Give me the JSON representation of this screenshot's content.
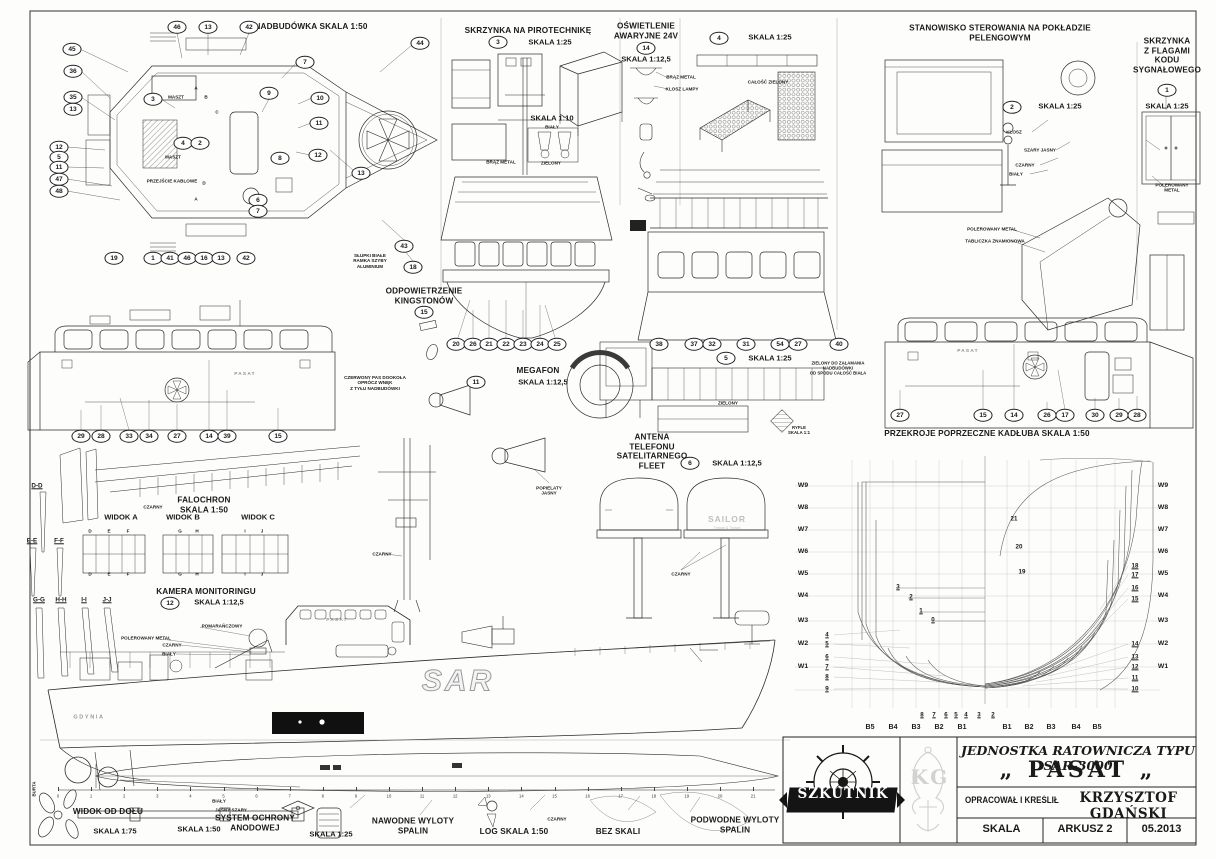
{
  "title_block": {
    "brand": "SZKUTNIK",
    "monogram": "KG",
    "line1": "JEDNOSTKA RATOWNICZA TYPU SAR-3000",
    "ship_name": "„ PASAT „",
    "credit_label": "OPRACOWAŁ I KREŚLIŁ",
    "credit_name": "KRZYSZTOF GDAŃSKI",
    "scale_label": "SKALA",
    "sheet_label": "ARKUSZ 2",
    "date": "05.2013"
  },
  "ruler": {
    "numbers": [
      0,
      1,
      2,
      3,
      4,
      5,
      6,
      7,
      8,
      9,
      10,
      11,
      12,
      13,
      14,
      15,
      16,
      17,
      18,
      19,
      20,
      21
    ],
    "x0": 58,
    "dx": 33.1,
    "y": 796
  },
  "callouts": [
    {
      "n": "46",
      "x": 177,
      "y": 27
    },
    {
      "n": "13",
      "x": 208,
      "y": 27
    },
    {
      "n": "42",
      "x": 249,
      "y": 27
    },
    {
      "n": "44",
      "x": 420,
      "y": 43
    },
    {
      "n": "45",
      "x": 72,
      "y": 49
    },
    {
      "n": "36",
      "x": 73,
      "y": 71
    },
    {
      "n": "35",
      "x": 73,
      "y": 97
    },
    {
      "n": "13",
      "x": 73,
      "y": 109
    },
    {
      "n": "12",
      "x": 59,
      "y": 147
    },
    {
      "n": "5",
      "x": 59,
      "y": 157
    },
    {
      "n": "11",
      "x": 59,
      "y": 167
    },
    {
      "n": "47",
      "x": 59,
      "y": 179
    },
    {
      "n": "48",
      "x": 59,
      "y": 191
    },
    {
      "n": "19",
      "x": 114,
      "y": 258
    },
    {
      "n": "1",
      "x": 153,
      "y": 258
    },
    {
      "n": "41",
      "x": 170,
      "y": 258
    },
    {
      "n": "46",
      "x": 187,
      "y": 258
    },
    {
      "n": "16",
      "x": 204,
      "y": 258
    },
    {
      "n": "13",
      "x": 221,
      "y": 258
    },
    {
      "n": "42",
      "x": 246,
      "y": 258
    },
    {
      "n": "7",
      "x": 305,
      "y": 62
    },
    {
      "n": "9",
      "x": 269,
      "y": 93
    },
    {
      "n": "10",
      "x": 320,
      "y": 98
    },
    {
      "n": "11",
      "x": 319,
      "y": 123
    },
    {
      "n": "12",
      "x": 318,
      "y": 155
    },
    {
      "n": "13",
      "x": 361,
      "y": 173
    },
    {
      "n": "3",
      "x": 153,
      "y": 99
    },
    {
      "n": "4",
      "x": 183,
      "y": 143
    },
    {
      "n": "2",
      "x": 200,
      "y": 143
    },
    {
      "n": "8",
      "x": 280,
      "y": 158
    },
    {
      "n": "6",
      "x": 258,
      "y": 200
    },
    {
      "n": "7",
      "x": 258,
      "y": 211
    },
    {
      "n": "43",
      "x": 404,
      "y": 246
    },
    {
      "n": "18",
      "x": 413,
      "y": 267
    },
    {
      "n": "3",
      "x": 498,
      "y": 42
    },
    {
      "n": "14",
      "x": 646,
      "y": 48
    },
    {
      "n": "4",
      "x": 719,
      "y": 38
    },
    {
      "n": "2",
      "x": 1012,
      "y": 107
    },
    {
      "n": "1",
      "x": 1167,
      "y": 90
    },
    {
      "n": "15",
      "x": 424,
      "y": 312
    },
    {
      "n": "20",
      "x": 456,
      "y": 344
    },
    {
      "n": "26",
      "x": 473,
      "y": 344
    },
    {
      "n": "21",
      "x": 489,
      "y": 344
    },
    {
      "n": "22",
      "x": 506,
      "y": 344
    },
    {
      "n": "23",
      "x": 523,
      "y": 344
    },
    {
      "n": "24",
      "x": 540,
      "y": 344
    },
    {
      "n": "25",
      "x": 557,
      "y": 344
    },
    {
      "n": "11",
      "x": 476,
      "y": 382
    },
    {
      "n": "38",
      "x": 659,
      "y": 344
    },
    {
      "n": "37",
      "x": 694,
      "y": 344
    },
    {
      "n": "32",
      "x": 712,
      "y": 344
    },
    {
      "n": "31",
      "x": 746,
      "y": 344
    },
    {
      "n": "54",
      "x": 780,
      "y": 344
    },
    {
      "n": "27",
      "x": 798,
      "y": 344
    },
    {
      "n": "40",
      "x": 839,
      "y": 344
    },
    {
      "n": "5",
      "x": 726,
      "y": 358
    },
    {
      "n": "6",
      "x": 690,
      "y": 463
    },
    {
      "n": "12",
      "x": 170,
      "y": 603
    },
    {
      "n": "29",
      "x": 81,
      "y": 436
    },
    {
      "n": "28",
      "x": 101,
      "y": 436
    },
    {
      "n": "33",
      "x": 129,
      "y": 436
    },
    {
      "n": "34",
      "x": 149,
      "y": 436
    },
    {
      "n": "27",
      "x": 177,
      "y": 436
    },
    {
      "n": "14",
      "x": 209,
      "y": 436
    },
    {
      "n": "39",
      "x": 227,
      "y": 436
    },
    {
      "n": "15",
      "x": 278,
      "y": 436
    },
    {
      "n": "27",
      "x": 900,
      "y": 415
    },
    {
      "n": "15",
      "x": 983,
      "y": 415
    },
    {
      "n": "14",
      "x": 1014,
      "y": 415
    },
    {
      "n": "26",
      "x": 1047,
      "y": 415
    },
    {
      "n": "17",
      "x": 1065,
      "y": 415
    },
    {
      "n": "30",
      "x": 1095,
      "y": 415
    },
    {
      "n": "29",
      "x": 1119,
      "y": 415
    },
    {
      "n": "28",
      "x": 1137,
      "y": 415
    }
  ],
  "annotations": [
    {
      "t": "NADBUDÓWKA SKALA 1:50",
      "x": 311,
      "y": 27,
      "c": "h1"
    },
    {
      "t": "SKRZYNKA NA PIROTECHNIKĘ",
      "x": 528,
      "y": 31,
      "c": "h1"
    },
    {
      "t": "SKALA 1:25",
      "x": 550,
      "y": 43,
      "c": "h2"
    },
    {
      "t": "SKALA 1:10",
      "x": 552,
      "y": 119,
      "c": "h2"
    },
    {
      "t": "OŚWIETLENIE\nAWARYJNE 24V",
      "x": 646,
      "y": 31,
      "c": "h1"
    },
    {
      "t": "SKALA 1:12,5",
      "x": 646,
      "y": 60,
      "c": "h2"
    },
    {
      "t": "SKALA 1:25",
      "x": 770,
      "y": 38,
      "c": "h2"
    },
    {
      "t": "STANOWISKO STEROWANIA NA POKŁADZIE PELENGOWYM",
      "x": 1000,
      "y": 33,
      "c": "h1"
    },
    {
      "t": "SKALA 1:25",
      "x": 1060,
      "y": 107,
      "c": "h2"
    },
    {
      "t": "SKRZYNKA\nZ FLAGAMI\nKODU\nSYGNAŁOWEGO",
      "x": 1167,
      "y": 56,
      "c": "h1"
    },
    {
      "t": "SKALA 1:25",
      "x": 1167,
      "y": 107,
      "c": "h2"
    },
    {
      "t": "ODPOWIETRZENIE\nKINGSTONÓW",
      "x": 424,
      "y": 296,
      "c": "h1"
    },
    {
      "t": "MEGAFON",
      "x": 538,
      "y": 371,
      "c": "h1"
    },
    {
      "t": "SKALA 1:12,5",
      "x": 543,
      "y": 383,
      "c": "h2"
    },
    {
      "t": "SKALA 1:25",
      "x": 770,
      "y": 359,
      "c": "h2"
    },
    {
      "t": "ANTENA\nTELEFONU\nSATELITARNEGO\nFLEET",
      "x": 652,
      "y": 452,
      "c": "h1"
    },
    {
      "t": "SKALA 1:12,5",
      "x": 737,
      "y": 464,
      "c": "h2"
    },
    {
      "t": "PRZEKROJE POPRZECZNE KADŁUBA  SKALA 1:50",
      "x": 987,
      "y": 434,
      "c": "h1"
    },
    {
      "t": "FALOCHRON\nSKALA 1:50",
      "x": 204,
      "y": 505,
      "c": "h1"
    },
    {
      "t": "WIDOK A",
      "x": 121,
      "y": 518,
      "c": "h2"
    },
    {
      "t": "WIDOK B",
      "x": 183,
      "y": 518,
      "c": "h2"
    },
    {
      "t": "WIDOK C",
      "x": 258,
      "y": 518,
      "c": "h2"
    },
    {
      "t": "KAMERA MONITORINGU",
      "x": 206,
      "y": 592,
      "c": "h1"
    },
    {
      "t": "SKALA 1:12,5",
      "x": 219,
      "y": 603,
      "c": "h2"
    },
    {
      "t": "RYFLE\nSKALA 1:1",
      "x": 799,
      "y": 430,
      "c": "tn"
    },
    {
      "t": "WIDOK OD DOŁU",
      "x": 108,
      "y": 812,
      "c": "h1"
    },
    {
      "t": "SKALA 1:75",
      "x": 115,
      "y": 832,
      "c": "h2"
    },
    {
      "t": "SKALA 1:50",
      "x": 199,
      "y": 830,
      "c": "h2"
    },
    {
      "t": "SYSTEM OCHRONY\nANODOWEJ",
      "x": 255,
      "y": 823,
      "c": "h1"
    },
    {
      "t": "SKALA 1:25",
      "x": 331,
      "y": 835,
      "c": "h2"
    },
    {
      "t": "NAWODNE WYLOTY\nSPALIN",
      "x": 413,
      "y": 826,
      "c": "h1"
    },
    {
      "t": "LOG  SKALA 1:50",
      "x": 514,
      "y": 832,
      "c": "h1"
    },
    {
      "t": "BEZ SKALI",
      "x": 618,
      "y": 832,
      "c": "h1"
    },
    {
      "t": "PODWODNE WYLOTY\nSPALIN",
      "x": 735,
      "y": 825,
      "c": "h1"
    },
    {
      "t": "MASZT",
      "x": 176,
      "y": 97,
      "c": "s"
    },
    {
      "t": "MASZT",
      "x": 173,
      "y": 157,
      "c": "s"
    },
    {
      "t": "PRZEJŚCIE KABLOWE",
      "x": 172,
      "y": 181,
      "c": "s"
    },
    {
      "t": "SŁUPKI BIAŁE\nRAMKA SZYBY\nALUMINIUM",
      "x": 370,
      "y": 261,
      "c": "s"
    },
    {
      "t": "BIAŁY",
      "x": 552,
      "y": 127,
      "c": "s"
    },
    {
      "t": "ZIELONY",
      "x": 551,
      "y": 163,
      "c": "s"
    },
    {
      "t": "BRĄZ METAL",
      "x": 501,
      "y": 162,
      "c": "s"
    },
    {
      "t": "BRĄZ METAL",
      "x": 681,
      "y": 77,
      "c": "s"
    },
    {
      "t": "KLOSZ LAMPY",
      "x": 682,
      "y": 89,
      "c": "s"
    },
    {
      "t": "CAŁOŚĆ ZIELONY",
      "x": 768,
      "y": 82,
      "c": "s"
    },
    {
      "t": "KLOSZ",
      "x": 1014,
      "y": 132,
      "c": "s"
    },
    {
      "t": "SZARY JASNY",
      "x": 1040,
      "y": 150,
      "c": "s"
    },
    {
      "t": "CZARNY",
      "x": 1025,
      "y": 165,
      "c": "s"
    },
    {
      "t": "BIAŁY",
      "x": 1016,
      "y": 174,
      "c": "s"
    },
    {
      "t": "POLEROWANY METAL",
      "x": 992,
      "y": 229,
      "c": "s"
    },
    {
      "t": "TABLICZKA ZNAMIONOWA",
      "x": 995,
      "y": 241,
      "c": "s"
    },
    {
      "t": "POLEROWANY METAL",
      "x": 1172,
      "y": 188,
      "c": "s"
    },
    {
      "t": "CZERWONY PAS DOOKOŁA\nOPRÓCZ WNĘK\nZ TYŁU NADBUDÓWKI",
      "x": 375,
      "y": 383,
      "c": "s"
    },
    {
      "t": "ZIELONY DO ZAŁAMANIA\nNADBUDÓWKI\nOD SPODU CAŁOŚĆ BIAŁA",
      "x": 838,
      "y": 368,
      "c": "tn"
    },
    {
      "t": "ZIELONY",
      "x": 728,
      "y": 403,
      "c": "s"
    },
    {
      "t": "CZARNY",
      "x": 153,
      "y": 507,
      "c": "s"
    },
    {
      "t": "CZARNY",
      "x": 382,
      "y": 554,
      "c": "s"
    },
    {
      "t": "POPIELATY\nJASNY",
      "x": 549,
      "y": 491,
      "c": "s"
    },
    {
      "t": "CZARNY",
      "x": 681,
      "y": 574,
      "c": "s"
    },
    {
      "t": "POMARAŃCZOWY",
      "x": 222,
      "y": 626,
      "c": "s"
    },
    {
      "t": "POLEROWANY METAL",
      "x": 146,
      "y": 638,
      "c": "s"
    },
    {
      "t": "CZARNY",
      "x": 172,
      "y": 645,
      "c": "s"
    },
    {
      "t": "BIAŁY",
      "x": 169,
      "y": 654,
      "c": "s"
    },
    {
      "t": "BIAŁY",
      "x": 219,
      "y": 801,
      "c": "s"
    },
    {
      "t": "JASNY SZARY",
      "x": 231,
      "y": 810,
      "c": "s"
    },
    {
      "t": "CZARNY",
      "x": 557,
      "y": 819,
      "c": "s"
    },
    {
      "t": "BURTA",
      "x": 34,
      "y": 789,
      "c": "vert"
    },
    {
      "t": "SAILOR",
      "x": 727,
      "y": 519,
      "c": "sailor"
    },
    {
      "t": "Thrane & Thrane",
      "x": 727,
      "y": 528,
      "c": "tt"
    },
    {
      "t": "PASAT",
      "x": 245,
      "y": 375,
      "c": "shipname"
    },
    {
      "t": "PASAT",
      "x": 968,
      "y": 352,
      "c": "shipname"
    },
    {
      "t": "PASAT",
      "x": 337,
      "y": 621,
      "c": "shipname"
    },
    {
      "t": "GDYNIA",
      "x": 89,
      "y": 718,
      "c": "gdynia"
    },
    {
      "t": "SAR",
      "x": 458,
      "y": 681,
      "c": "sar"
    },
    {
      "t": "D",
      "x": 90,
      "y": 531,
      "c": "s"
    },
    {
      "t": "E",
      "x": 109,
      "y": 531,
      "c": "s"
    },
    {
      "t": "F",
      "x": 128,
      "y": 531,
      "c": "s"
    },
    {
      "t": "G",
      "x": 180,
      "y": 531,
      "c": "s"
    },
    {
      "t": "H",
      "x": 197,
      "y": 531,
      "c": "s"
    },
    {
      "t": "I",
      "x": 245,
      "y": 531,
      "c": "s"
    },
    {
      "t": "J",
      "x": 262,
      "y": 531,
      "c": "s"
    },
    {
      "t": "D",
      "x": 90,
      "y": 574,
      "c": "s"
    },
    {
      "t": "E",
      "x": 109,
      "y": 574,
      "c": "s"
    },
    {
      "t": "F",
      "x": 128,
      "y": 574,
      "c": "s"
    },
    {
      "t": "G",
      "x": 180,
      "y": 574,
      "c": "s"
    },
    {
      "t": "H",
      "x": 197,
      "y": 574,
      "c": "s"
    },
    {
      "t": "I",
      "x": 245,
      "y": 574,
      "c": "s"
    },
    {
      "t": "J",
      "x": 262,
      "y": 574,
      "c": "s"
    },
    {
      "t": "A",
      "x": 196,
      "y": 88,
      "c": "s"
    },
    {
      "t": "B",
      "x": 206,
      "y": 97,
      "c": "s"
    },
    {
      "t": "C",
      "x": 217,
      "y": 112,
      "c": "s"
    },
    {
      "t": "D",
      "x": 204,
      "y": 183,
      "c": "s"
    },
    {
      "t": "A",
      "x": 196,
      "y": 199,
      "c": "s"
    },
    {
      "t": "D-D",
      "x": 37,
      "y": 486,
      "c": "h3"
    },
    {
      "t": "E-E",
      "x": 32,
      "y": 541,
      "c": "h3"
    },
    {
      "t": "F-F",
      "x": 59,
      "y": 541,
      "c": "h3"
    },
    {
      "t": "G-G",
      "x": 39,
      "y": 600,
      "c": "h3"
    },
    {
      "t": "H-H",
      "x": 61,
      "y": 600,
      "c": "h3"
    },
    {
      "t": "I-I",
      "x": 84,
      "y": 600,
      "c": "h3"
    },
    {
      "t": "J-J",
      "x": 107,
      "y": 600,
      "c": "h3"
    },
    {
      "t": "W9",
      "x": 803,
      "y": 486,
      "c": "w"
    },
    {
      "t": "W8",
      "x": 803,
      "y": 508,
      "c": "w"
    },
    {
      "t": "W7",
      "x": 803,
      "y": 530,
      "c": "w"
    },
    {
      "t": "W6",
      "x": 803,
      "y": 552,
      "c": "w"
    },
    {
      "t": "W5",
      "x": 803,
      "y": 574,
      "c": "w"
    },
    {
      "t": "W4",
      "x": 803,
      "y": 596,
      "c": "w"
    },
    {
      "t": "W3",
      "x": 803,
      "y": 621,
      "c": "w"
    },
    {
      "t": "W2",
      "x": 803,
      "y": 644,
      "c": "w"
    },
    {
      "t": "W1",
      "x": 803,
      "y": 667,
      "c": "w"
    },
    {
      "t": "W9",
      "x": 1163,
      "y": 486,
      "c": "w"
    },
    {
      "t": "W8",
      "x": 1163,
      "y": 508,
      "c": "w"
    },
    {
      "t": "W7",
      "x": 1163,
      "y": 530,
      "c": "w"
    },
    {
      "t": "W6",
      "x": 1163,
      "y": 552,
      "c": "w"
    },
    {
      "t": "W5",
      "x": 1163,
      "y": 574,
      "c": "w"
    },
    {
      "t": "W4",
      "x": 1163,
      "y": 596,
      "c": "w"
    },
    {
      "t": "W3",
      "x": 1163,
      "y": 621,
      "c": "w"
    },
    {
      "t": "W2",
      "x": 1163,
      "y": 644,
      "c": "w"
    },
    {
      "t": "W1",
      "x": 1163,
      "y": 667,
      "c": "w"
    },
    {
      "t": "4",
      "x": 827,
      "y": 635,
      "c": "fn"
    },
    {
      "t": "5",
      "x": 827,
      "y": 644,
      "c": "fn"
    },
    {
      "t": "6",
      "x": 827,
      "y": 657,
      "c": "fn"
    },
    {
      "t": "7",
      "x": 827,
      "y": 667,
      "c": "fn"
    },
    {
      "t": "8",
      "x": 827,
      "y": 677,
      "c": "fn"
    },
    {
      "t": "9",
      "x": 827,
      "y": 689,
      "c": "fn"
    },
    {
      "t": "3",
      "x": 898,
      "y": 587,
      "c": "fn"
    },
    {
      "t": "2",
      "x": 911,
      "y": 597,
      "c": "fn"
    },
    {
      "t": "1",
      "x": 921,
      "y": 611,
      "c": "fn"
    },
    {
      "t": "0",
      "x": 933,
      "y": 620,
      "c": "fn"
    },
    {
      "t": "18",
      "x": 1135,
      "y": 566,
      "c": "fn"
    },
    {
      "t": "17",
      "x": 1135,
      "y": 575,
      "c": "fn"
    },
    {
      "t": "16",
      "x": 1135,
      "y": 588,
      "c": "fn"
    },
    {
      "t": "15",
      "x": 1135,
      "y": 599,
      "c": "fn"
    },
    {
      "t": "14",
      "x": 1135,
      "y": 644,
      "c": "fn"
    },
    {
      "t": "13",
      "x": 1135,
      "y": 657,
      "c": "fn"
    },
    {
      "t": "12",
      "x": 1135,
      "y": 667,
      "c": "fn"
    },
    {
      "t": "11",
      "x": 1135,
      "y": 678,
      "c": "fn"
    },
    {
      "t": "10",
      "x": 1135,
      "y": 689,
      "c": "fn"
    },
    {
      "t": "21",
      "x": 1014,
      "y": 519,
      "c": "fn2"
    },
    {
      "t": "20",
      "x": 1019,
      "y": 547,
      "c": "fn2"
    },
    {
      "t": "19",
      "x": 1022,
      "y": 572,
      "c": "fn2"
    },
    {
      "t": "8",
      "x": 922,
      "y": 715,
      "c": "fn"
    },
    {
      "t": "7",
      "x": 934,
      "y": 715,
      "c": "fn"
    },
    {
      "t": "6",
      "x": 946,
      "y": 715,
      "c": "fn"
    },
    {
      "t": "5",
      "x": 956,
      "y": 715,
      "c": "fn"
    },
    {
      "t": "4",
      "x": 966,
      "y": 715,
      "c": "fn"
    },
    {
      "t": "3",
      "x": 979,
      "y": 715,
      "c": "fn"
    },
    {
      "t": "2",
      "x": 993,
      "y": 715,
      "c": "fn"
    },
    {
      "t": "B5",
      "x": 870,
      "y": 728,
      "c": "b"
    },
    {
      "t": "B4",
      "x": 893,
      "y": 728,
      "c": "b"
    },
    {
      "t": "B3",
      "x": 916,
      "y": 728,
      "c": "b"
    },
    {
      "t": "B2",
      "x": 939,
      "y": 728,
      "c": "b"
    },
    {
      "t": "B1",
      "x": 962,
      "y": 728,
      "c": "b"
    },
    {
      "t": "B1",
      "x": 1007,
      "y": 728,
      "c": "b"
    },
    {
      "t": "B2",
      "x": 1029,
      "y": 728,
      "c": "b"
    },
    {
      "t": "B3",
      "x": 1051,
      "y": 728,
      "c": "b"
    },
    {
      "t": "B4",
      "x": 1076,
      "y": 728,
      "c": "b"
    },
    {
      "t": "B5",
      "x": 1097,
      "y": 728,
      "c": "b"
    }
  ]
}
